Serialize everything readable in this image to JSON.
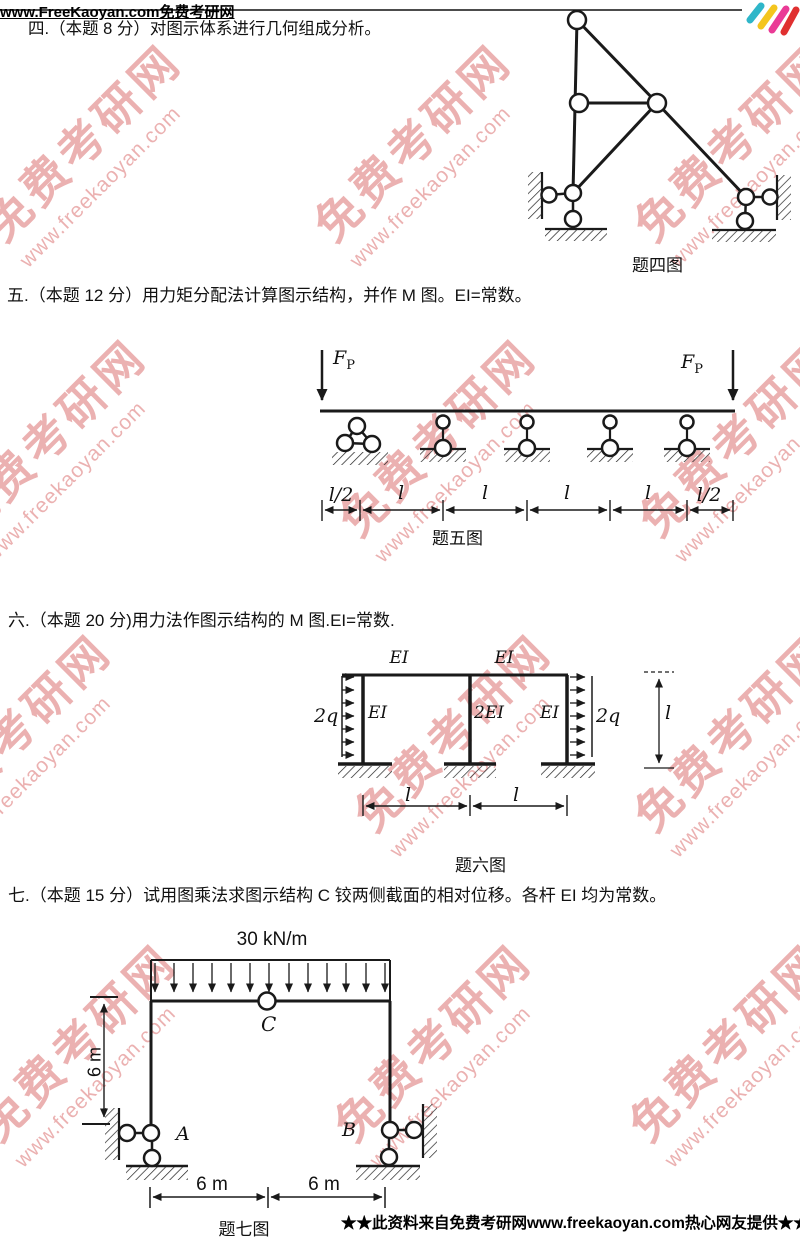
{
  "header": {
    "site_text": "www.FreeKaoyan.com免费考研网",
    "logo_colors": [
      "#2fb6c9",
      "#f4c51e",
      "#ea3a96",
      "#e03030"
    ]
  },
  "watermark": {
    "line1": "免费考研网",
    "line2": "www.freekaoyan.com",
    "color": "#d96666"
  },
  "problem4": {
    "title": "四.（本题 8 分）对图示体系进行几何组成分析。",
    "caption": "题四图"
  },
  "problem5": {
    "title": "五.（本题 12 分）用力矩分配法计算图示结构，并作 M 图。EI=常数。",
    "force_main": "F",
    "force_sub": "P",
    "dims": [
      "l/2",
      "l",
      "l",
      "l",
      "l",
      "l/2"
    ],
    "caption": "题五图"
  },
  "problem6": {
    "title": "六.（本题 20 分)用力法作图示结构的 M 图.EI=常数.",
    "beam_labels": [
      "EI",
      "EI"
    ],
    "column_labels": [
      "EI",
      "2EI",
      "EI"
    ],
    "load_labels": [
      "2q",
      "2q"
    ],
    "height_label": "l",
    "span_labels": [
      "l",
      "l"
    ],
    "caption": "题六图"
  },
  "problem7": {
    "title": "七.（本题 15 分）试用图乘法求图示结构 C 铰两侧截面的相对位移。各杆 EI 均为常数。",
    "load_label": "30 kN/m",
    "hinge_label": "C",
    "support_left": "A",
    "support_right": "B",
    "height_label": "6 m",
    "span_labels": [
      "6 m",
      "6 m"
    ],
    "caption": "题七图"
  },
  "footer": {
    "text": "★★此资料来自免费考研网www.freekaoyan.com热心网友提供★★"
  }
}
